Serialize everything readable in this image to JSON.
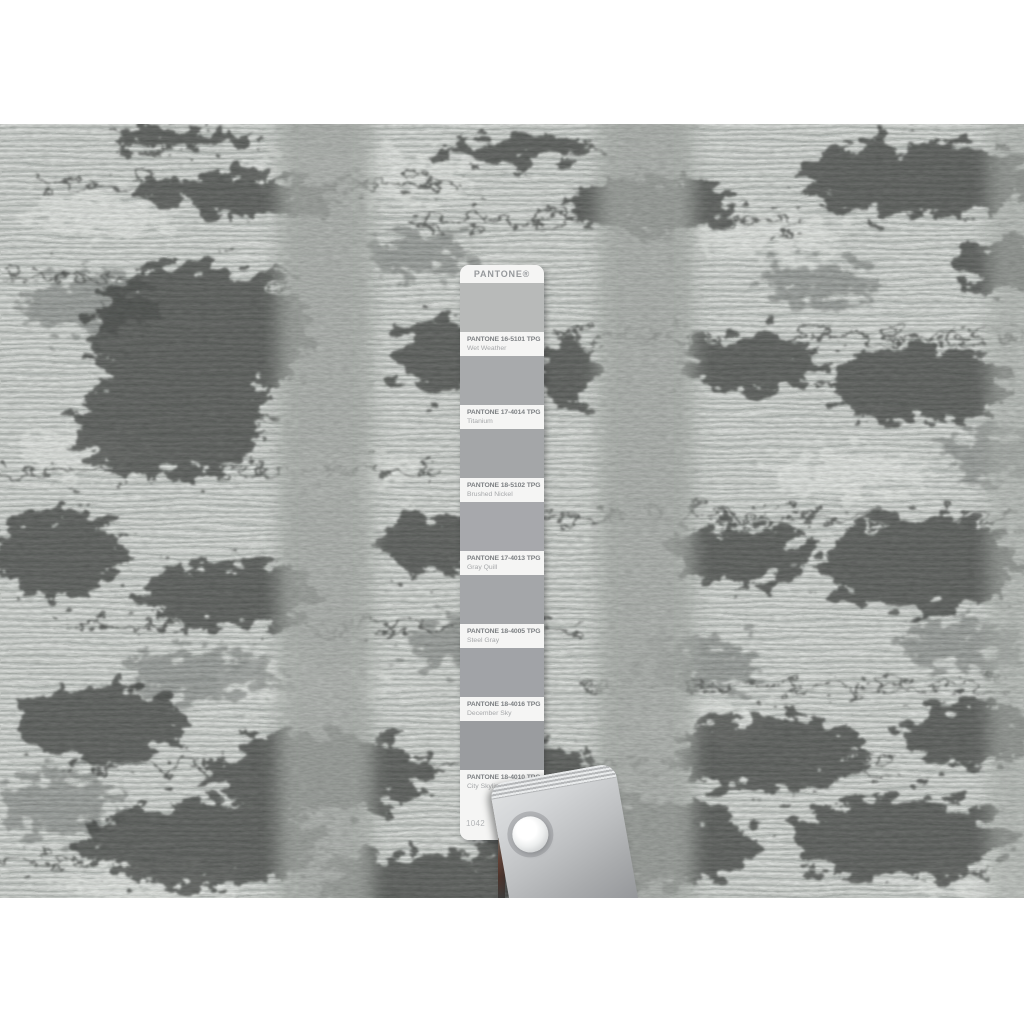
{
  "photo": {
    "subject": "close-up of a gray hand-knotted rug texture with charcoal abstract patches and smooth gray vertical bands",
    "palette": {
      "page_background": "#ffffff",
      "rug_base": "#c9cdca",
      "rug_highlight": "#eaede9",
      "rug_dark_patch": "#3f4241",
      "rug_medium_patch": "#6e7270",
      "smooth_band": "#a9ada9"
    }
  },
  "pantone_card": {
    "brand": "PANTONE®",
    "page_number": "1042",
    "rows": [
      {
        "code": "PANTONE 16-5101 TPG",
        "name": "Wet Weather",
        "chip_color": "#b8bab9"
      },
      {
        "code": "PANTONE 17-4014 TPG",
        "name": "Titanium",
        "chip_color": "#a8aaac"
      },
      {
        "code": "PANTONE 18-5102 TPG",
        "name": "Brushed Nickel",
        "chip_color": "#a4a6a8"
      },
      {
        "code": "PANTONE 17-4013 TPG",
        "name": "Gray Quill",
        "chip_color": "#a7a8ac"
      },
      {
        "code": "PANTONE 18-4005 TPG",
        "name": "Steel Gray",
        "chip_color": "#a4a6a9"
      },
      {
        "code": "PANTONE 18-4016 TPG",
        "name": "December Sky",
        "chip_color": "#a1a3a7"
      },
      {
        "code": "PANTONE 18-4010 TPG",
        "name": "City Skyline",
        "chip_color": "#9a9c9f"
      }
    ]
  },
  "clamp": {
    "metal_light": "#e2e4e5",
    "metal_dark": "#8c8e91",
    "rivet_color": "#ffffff"
  }
}
